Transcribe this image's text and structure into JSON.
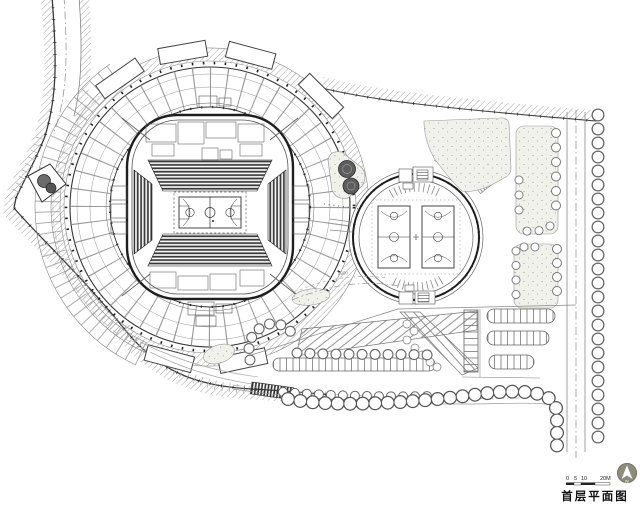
{
  "title_block": {
    "plan_title": "首层平面图",
    "scale_bar": {
      "labels": [
        "0",
        "5",
        "10",
        "20M"
      ]
    },
    "north_arrow": {
      "label": "N"
    }
  },
  "annotations": {
    "path_dimension_label": "5900"
  },
  "colors": {
    "paper": "#ffffff",
    "ink_dark": "#2b2b2b",
    "ink_mid": "#666666",
    "ink_light": "#9a9a9a",
    "green_fill": "#f1f1ec",
    "compass_fill": "#8d8d7d"
  }
}
